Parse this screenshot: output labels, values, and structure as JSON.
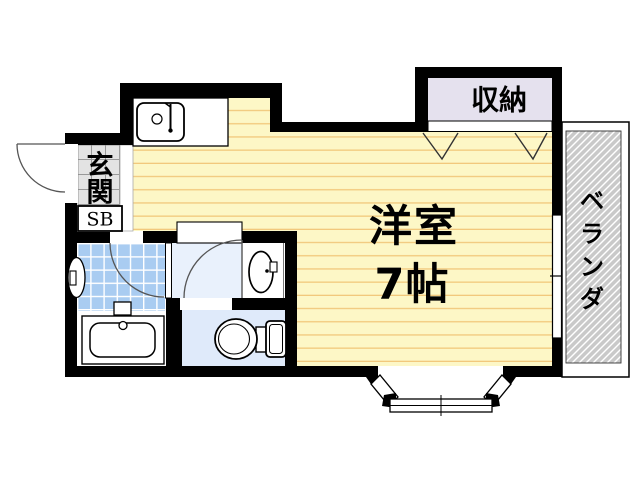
{
  "floor_plan": {
    "rooms": {
      "living": {
        "name": "洋室",
        "size": "7帖"
      },
      "genkan": {
        "label": "玄関"
      },
      "shoe_box": {
        "label": "SB"
      },
      "closet": {
        "label": "収納"
      },
      "veranda": {
        "label": "ベランダ"
      }
    },
    "colors": {
      "wall": "#000000",
      "living_floor": "#fdf7c6",
      "living_stripe": "#f2c87c",
      "bath_tile": "#a9ccf1",
      "toilet_floor": "#dfeafa",
      "washroom_floor": "#e9f1fc",
      "closet_fill": "#e5e1ee",
      "genkan_tile": "#e3e3e3",
      "veranda_fill": "#c9c9c9"
    }
  }
}
